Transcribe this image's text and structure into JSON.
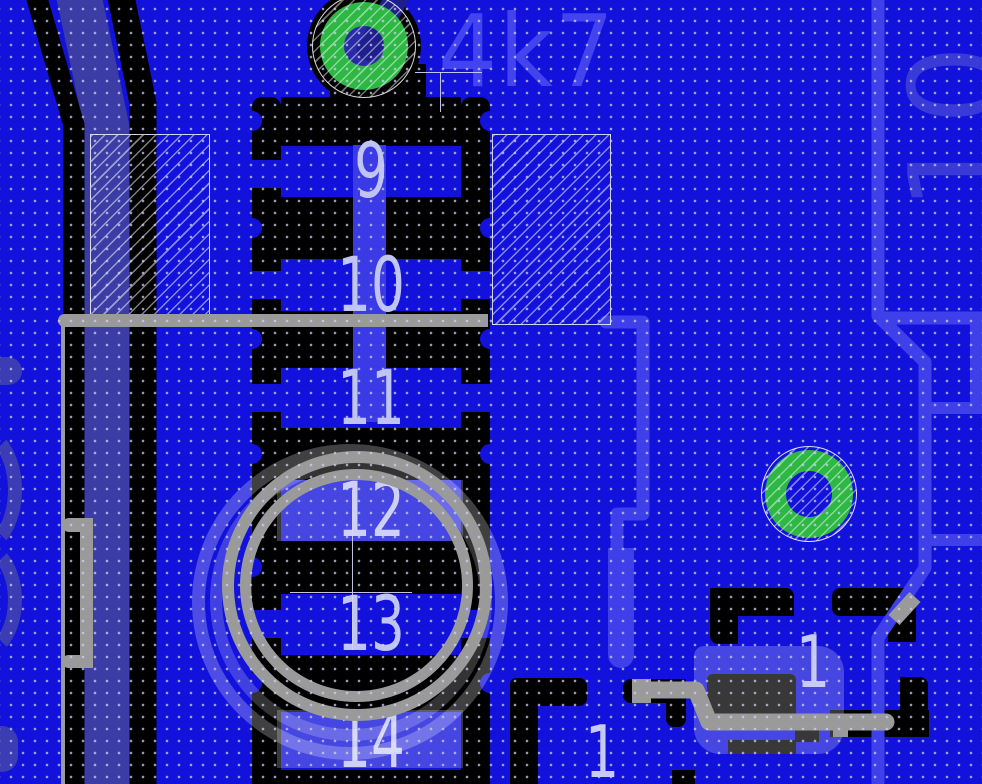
{
  "app": {
    "view": "pcb-layout-editor-canvas"
  },
  "designators": {
    "resistor_value": "4k7",
    "net_label_right": "10"
  },
  "connector_pins": {
    "labels": [
      "9",
      "10",
      "11",
      "12",
      "13",
      "14"
    ]
  },
  "pad_labels": {
    "left_pin": "1",
    "right_pin": "1"
  },
  "colors": {
    "copper_background": "#1212dc",
    "trace_light_blue": "#4040ea",
    "trace_inner_band": "#3a3ae6",
    "trace_slate": "#3c3ca6",
    "trace_dark_navy": "#1e1e8c",
    "pad_black": "#000000",
    "via_green": "#2db844",
    "silkscreen_gray": "#9a9a9a",
    "pin_label": "#c0c4f2",
    "selection_overlay": "rgba(255,255,255,0.22)",
    "grid_dot": "#b4b8e8"
  }
}
